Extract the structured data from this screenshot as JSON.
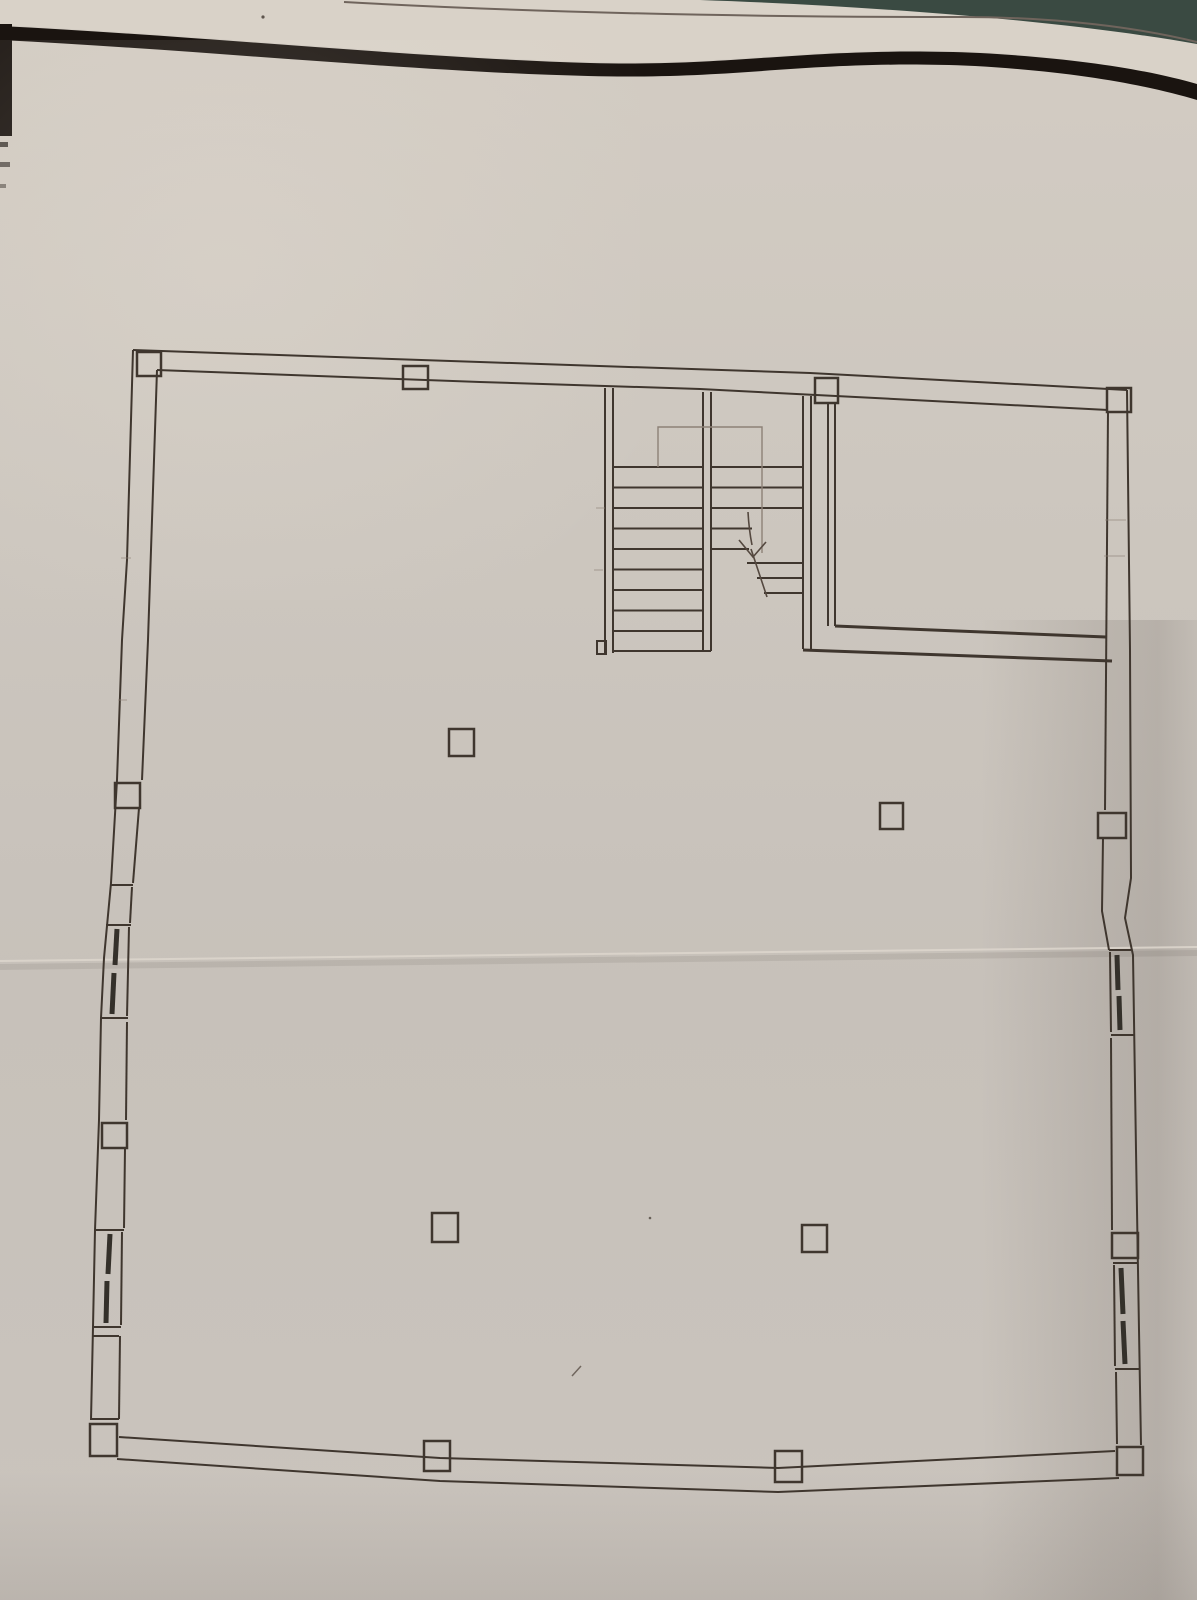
{
  "meta": {
    "title": "Photographed architectural floor plan sheet (no text labels visible)"
  },
  "colors": {
    "background_teal": "#3a4a42",
    "paper_light": "#d9d2c8",
    "paper": "#cdc7bf",
    "paper_dark": "#c5bfb8",
    "ink": "#3f362e",
    "ink_light": "#8d8177",
    "glazing": "#34302a",
    "page_border": "#1a1410",
    "page_edge_line": "#6f645c",
    "crease": "#dcd5cc"
  },
  "drawing": {
    "type": "floor-plan",
    "text_labels": [],
    "features": {
      "staircase": {
        "flights": 2,
        "left_flight_steps": 10,
        "right_flight_steps": 8,
        "direction_arrow": "down"
      },
      "interior_columns": 4,
      "perimeter_columns": 12,
      "windows": {
        "left_wall": 2,
        "right_wall": 2
      },
      "spaces": [
        "main-hall",
        "stairwell",
        "upper-right-room"
      ]
    }
  }
}
